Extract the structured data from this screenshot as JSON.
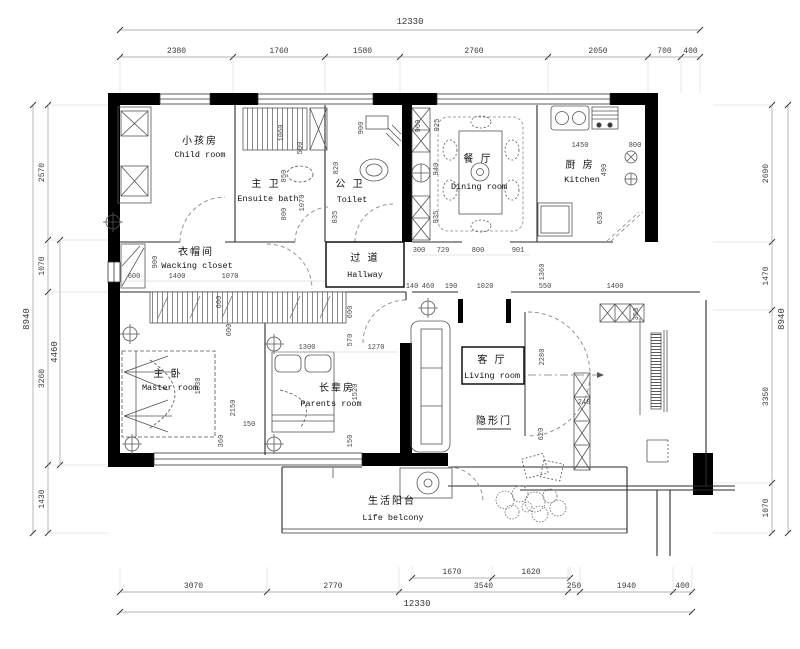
{
  "rooms": [
    {
      "id": "child-room",
      "zh": "小孩房",
      "en": "Child room",
      "zx": 200,
      "zy": 144,
      "ex": 200,
      "ey": 157
    },
    {
      "id": "ensuite-bath",
      "zh": "主 卫",
      "en": "Ensuite bath",
      "zx": 266,
      "zy": 187,
      "ex": 268,
      "ey": 201
    },
    {
      "id": "toilet",
      "zh": "公 卫",
      "en": "Toilet",
      "zx": 350,
      "zy": 187,
      "ex": 352,
      "ey": 202
    },
    {
      "id": "dining-room",
      "zh": "餐 厅",
      "en": "Dining room",
      "zx": 478,
      "zy": 162,
      "ex": 479,
      "ey": 189
    },
    {
      "id": "kitchen",
      "zh": "厨 房",
      "en": "Kitchen",
      "zx": 580,
      "zy": 168,
      "ex": 582,
      "ey": 182
    },
    {
      "id": "walking-closet",
      "zh": "衣帽间",
      "en": "Wacking closet",
      "zx": 196,
      "zy": 255,
      "ex": 197,
      "ey": 268
    },
    {
      "id": "hallway",
      "zh": "过 道",
      "en": "Hallway",
      "zx": 365,
      "zy": 261,
      "ex": 365,
      "ey": 277,
      "box": [
        326,
        242,
        78,
        45
      ]
    },
    {
      "id": "master-room",
      "zh": "主 卧",
      "en": "Master room",
      "zx": 168,
      "zy": 377,
      "ex": 170,
      "ey": 390
    },
    {
      "id": "parents-room",
      "zh": "长辈房",
      "en": "Parents room",
      "zx": 337,
      "zy": 391,
      "ex": 331,
      "ey": 406
    },
    {
      "id": "living-room",
      "zh": "客 厅",
      "en": "Living room",
      "zx": 492,
      "zy": 363,
      "ex": 492,
      "ey": 378,
      "box": [
        462,
        347,
        62,
        37
      ]
    },
    {
      "id": "life-balcony",
      "zh": "生活阳台",
      "en": "Life belcony",
      "zx": 392,
      "zy": 504,
      "ex": 393,
      "ey": 520
    },
    {
      "id": "hidden-door",
      "zh": "隐形门",
      "en": "",
      "zx": 494,
      "zy": 424,
      "ul": [
        477,
        429,
        511,
        429
      ]
    }
  ],
  "chains": [
    {
      "name": "top-total",
      "orient": "h",
      "line": 30,
      "from": 120,
      "to": 700,
      "label": "12330",
      "lx": 410,
      "ly": 24
    },
    {
      "name": "top",
      "orient": "h",
      "line": 57,
      "ticks": [
        120,
        233,
        325,
        400,
        548,
        648,
        681,
        700
      ],
      "labels": [
        "2380",
        "1760",
        "1580",
        "2760",
        "2050",
        "700",
        "400"
      ],
      "ext": 36
    },
    {
      "name": "left-total",
      "orient": "v",
      "line": 33,
      "from": 105,
      "to": 533,
      "label": "8940",
      "lx": 29,
      "ly": 319
    },
    {
      "name": "left-mid",
      "orient": "v",
      "line": 60,
      "from": 240,
      "to": 465,
      "label": "4460",
      "lx": 57,
      "ly": 352
    },
    {
      "name": "left",
      "orient": "v",
      "line": 48,
      "ticks": [
        105,
        240,
        292,
        465,
        533
      ],
      "labels": [
        "2570",
        "1070",
        "3260",
        "1430"
      ],
      "ext": 60
    },
    {
      "name": "right",
      "orient": "v",
      "line": 772,
      "ticks": [
        105,
        242,
        310,
        483,
        533
      ],
      "labels": [
        "2690",
        "1470",
        "3350",
        "1070"
      ],
      "ext": -59
    },
    {
      "name": "right-total",
      "orient": "v",
      "line": 788,
      "from": 105,
      "to": 533,
      "label": "8940",
      "lx": 784,
      "ly": 319
    },
    {
      "name": "bottom-inner",
      "orient": "h",
      "line": 578,
      "ticks": [
        412,
        492,
        570
      ],
      "labels": [
        "1670",
        "1620"
      ],
      "ext": -12
    },
    {
      "name": "bottom",
      "orient": "h",
      "line": 592,
      "ticks": [
        120,
        267,
        399,
        568,
        580,
        673,
        692
      ],
      "labels": [
        "3070",
        "2770",
        "3540",
        "250",
        "1940",
        "400"
      ],
      "ext": -25
    },
    {
      "name": "bottom-total",
      "orient": "h",
      "line": 612,
      "from": 120,
      "to": 692,
      "label": "12330",
      "lx": 417,
      "ly": 606
    }
  ],
  "interior_dims": [
    [
      "500",
      302,
      148,
      1
    ],
    [
      "1070",
      304,
      203,
      1
    ],
    [
      "1060",
      283,
      133,
      1
    ],
    [
      "850",
      286,
      176,
      1
    ],
    [
      "800",
      286,
      214,
      1
    ],
    [
      "900",
      363,
      128,
      1
    ],
    [
      "820",
      338,
      168,
      1
    ],
    [
      "835",
      337,
      217,
      1
    ],
    [
      "960",
      420,
      126,
      1
    ],
    [
      "925",
      439,
      125,
      1
    ],
    [
      "940",
      438,
      169,
      1
    ],
    [
      "935",
      438,
      217,
      1
    ],
    [
      "300",
      419,
      252,
      0
    ],
    [
      "729",
      443,
      252,
      0
    ],
    [
      "800",
      478,
      252,
      0
    ],
    [
      "901",
      518,
      252,
      0
    ],
    [
      "1450",
      580,
      147,
      0
    ],
    [
      "800",
      635,
      147,
      0
    ],
    [
      "490",
      606,
      170,
      1
    ],
    [
      "630",
      602,
      218,
      1
    ],
    [
      "900",
      157,
      262,
      1
    ],
    [
      "600",
      134,
      278,
      0
    ],
    [
      "1400",
      177,
      278,
      0
    ],
    [
      "1070",
      230,
      278,
      0
    ],
    [
      "600",
      221,
      302,
      1
    ],
    [
      "600",
      231,
      330,
      1
    ],
    [
      "1830",
      200,
      386,
      1
    ],
    [
      "2150",
      235,
      408,
      1
    ],
    [
      "150",
      249,
      426,
      0
    ],
    [
      "360",
      223,
      441,
      1
    ],
    [
      "600",
      352,
      312,
      1
    ],
    [
      "570",
      352,
      340,
      1
    ],
    [
      "1300",
      307,
      349,
      0
    ],
    [
      "1270",
      376,
      349,
      0
    ],
    [
      "1520",
      357,
      392,
      1
    ],
    [
      "150",
      352,
      441,
      1
    ],
    [
      "140",
      412,
      288,
      0
    ],
    [
      "460",
      428,
      288,
      0
    ],
    [
      "190",
      451,
      288,
      0
    ],
    [
      "1020",
      485,
      288,
      0
    ],
    [
      "550",
      545,
      288,
      0
    ],
    [
      "1400",
      615,
      288,
      0
    ],
    [
      "1360",
      544,
      272,
      1
    ],
    [
      "2280",
      544,
      357,
      1
    ],
    [
      "240",
      584,
      404,
      0
    ],
    [
      "620",
      543,
      434,
      1
    ],
    [
      "350",
      638,
      314,
      1
    ]
  ],
  "colors": {
    "wall": "#000000",
    "line": "#2b2b2b",
    "furniture": "#555555",
    "dash": "#8a8a8a",
    "dim_text": "#3a3a3a",
    "background": "#ffffff"
  }
}
